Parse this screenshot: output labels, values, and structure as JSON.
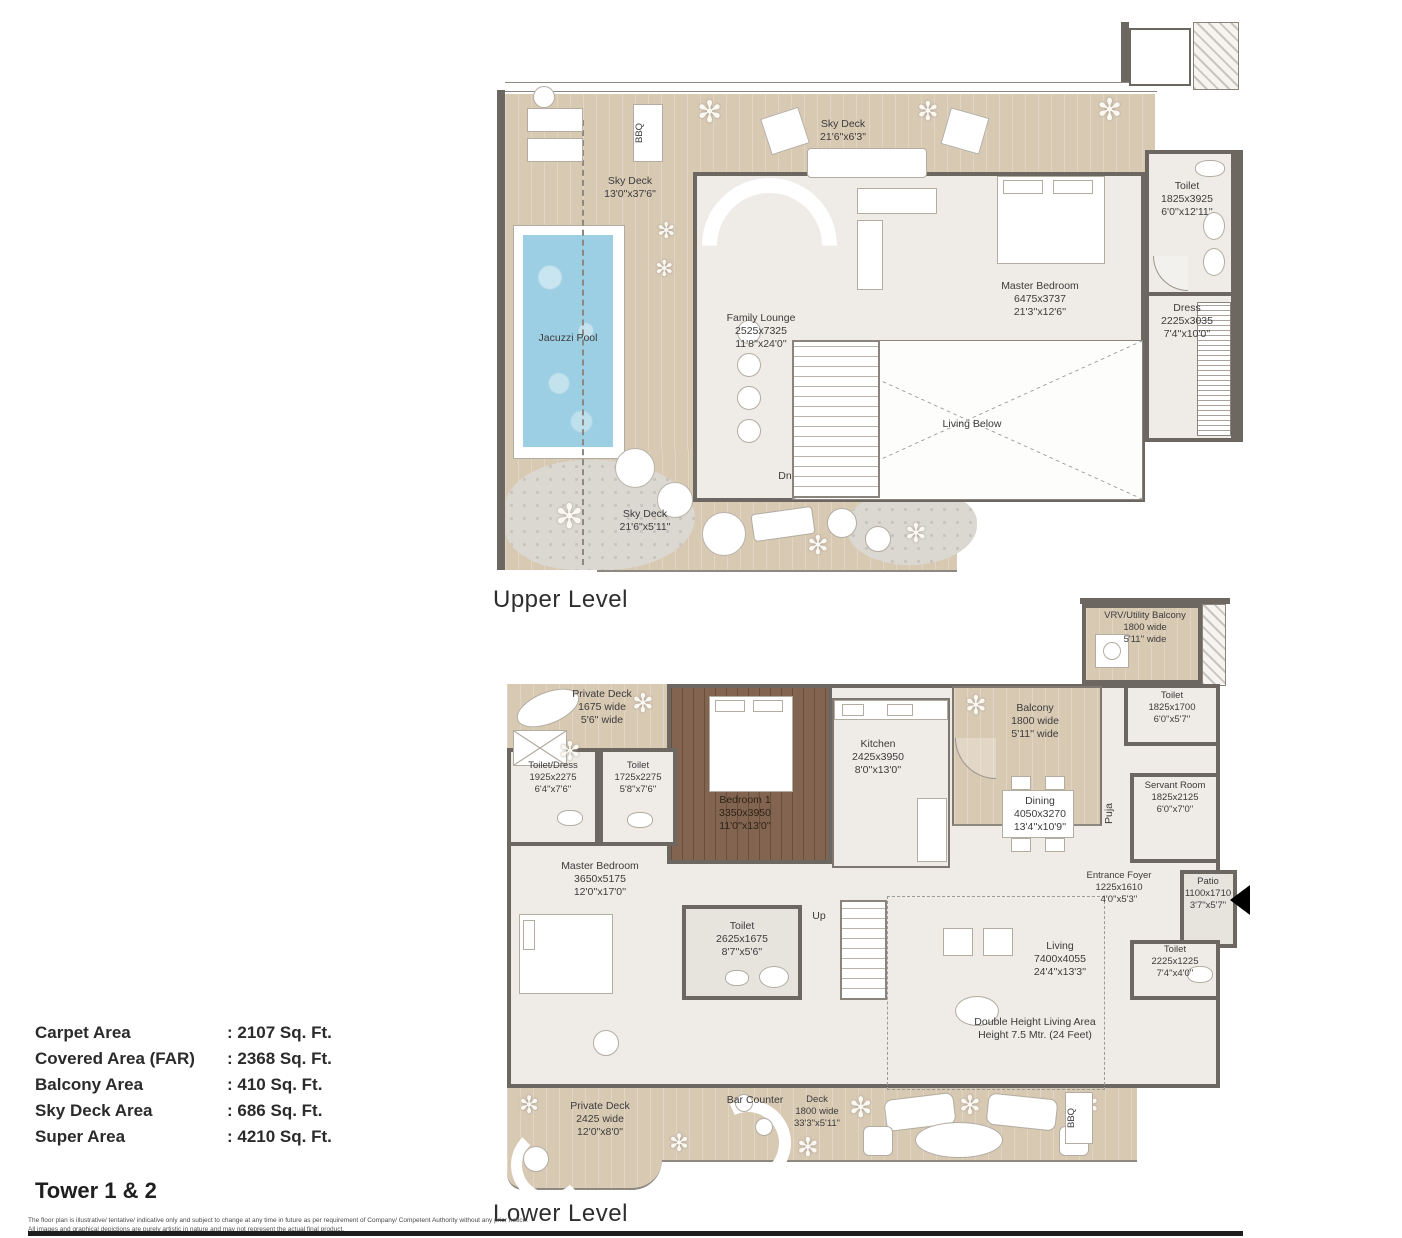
{
  "upper": {
    "caption": "Upper Level",
    "bbq": "BBQ",
    "sky_deck_top": {
      "name": "Sky Deck",
      "ft": "21'6\"x6'3\""
    },
    "sky_deck_left": {
      "name": "Sky Deck",
      "ft": "13'0\"x37'6\""
    },
    "jacuzzi_pool": "Jacuzzi Pool",
    "family_lounge": {
      "name": "Family Lounge",
      "mm": "2525x7325",
      "ft": "11'8''x24'0''"
    },
    "master_bedroom": {
      "name": "Master Bedroom",
      "mm": "6475x3737",
      "ft": "21'3''x12'6''"
    },
    "toilet": {
      "name": "Toilet",
      "mm": "1825x3925",
      "ft": "6'0''x12'11''"
    },
    "dress": {
      "name": "Dress",
      "mm": "2225x3035",
      "ft": "7'4''x10'0''"
    },
    "living_below": "Living Below",
    "dn": "Dn",
    "sky_deck_bottom": {
      "name": "Sky Deck",
      "ft": "21'6\"x5'11\""
    }
  },
  "lower": {
    "caption": "Lower Level",
    "vrv_balcony": {
      "name": "VRV/Utility Balcony",
      "mm": "1800 wide",
      "ft": "5'11'' wide"
    },
    "toilet_vrv": {
      "name": "Toilet",
      "mm": "1825x1700",
      "ft": "6'0''x5'7''"
    },
    "private_deck_top": {
      "name": "Private Deck",
      "mm": "1675 wide",
      "ft": "5'6'' wide"
    },
    "toilet_dress": {
      "name": "Toilet/Dress",
      "mm": "1925x2275",
      "ft": "6'4''x7'6''"
    },
    "toilet_2": {
      "name": "Toilet",
      "mm": "1725x2275",
      "ft": "5'8''x7'6''"
    },
    "bedroom_1": {
      "name": "Bedroom 1",
      "mm": "3350x3950",
      "ft": "11'0''x13'0''"
    },
    "kitchen": {
      "name": "Kitchen",
      "mm": "2425x3950",
      "ft": "8'0''x13'0''"
    },
    "balcony": {
      "name": "Balcony",
      "mm": "1800 wide",
      "ft": "5'11'' wide"
    },
    "dining": {
      "name": "Dining",
      "mm": "4050x3270",
      "ft": "13'4''x10'9''"
    },
    "puja": "Puja",
    "servant_room": {
      "name": "Servant Room",
      "mm": "1825x2125",
      "ft": "6'0''x7'0''"
    },
    "entrance_foyer": {
      "name": "Entrance Foyer",
      "mm": "1225x1610",
      "ft": "4'0''x5'3''"
    },
    "patio": {
      "name": "Patio",
      "mm": "1100x1710",
      "ft": "3'7\"x5'7\""
    },
    "toilet_patio": {
      "name": "Toilet",
      "mm": "2225x1225",
      "ft": "7'4''x4'0''"
    },
    "master_bedroom": {
      "name": "Master Bedroom",
      "mm": "3650x5175",
      "ft": "12'0''x17'0''"
    },
    "toilet_3": {
      "name": "Toilet",
      "mm": "2625x1675",
      "ft": "8'7''x5'6''"
    },
    "up": "Up",
    "living": {
      "name": "Living",
      "mm": "7400x4055",
      "ft": "24'4''x13'3''"
    },
    "double_height": {
      "line1": "Double Height Living Area",
      "line2": "Height 7.5 Mtr. (24 Feet)"
    },
    "private_deck_bottom": {
      "name": "Private Deck",
      "mm": "2425 wide",
      "ft": "12'0\"x8'0\""
    },
    "bar_counter": "Bar Counter",
    "deck": {
      "name": "Deck",
      "mm": "1800 wide",
      "ft": "33'3\"x5'11\""
    },
    "bbq": "BBQ"
  },
  "stats": {
    "rows": [
      {
        "label": "Carpet Area",
        "value": "2107 Sq. Ft."
      },
      {
        "label": "Covered Area (FAR)",
        "value": "2368 Sq. Ft."
      },
      {
        "label": "Balcony Area",
        "value": "410 Sq. Ft."
      },
      {
        "label": "Sky Deck Area",
        "value": "686 Sq. Ft."
      },
      {
        "label": "Super Area",
        "value": "4210 Sq. Ft."
      }
    ]
  },
  "footer": {
    "title": "Tower 1 & 2",
    "disclaimer_1": "The floor plan is illustrative/ tentative/ indicative only and subject to change at any time in future as per requirement of Company/ Competent Authority without any prior notice.",
    "disclaimer_2": "All images and graphical depictions are purely artistic in nature and may not represent the actual final product."
  },
  "colors": {
    "deck_wood": "#d8c9b3",
    "dark_wood": "#7a5b46",
    "marble": "#efece7",
    "pool_blue": "#9ccfe3",
    "wall": "#6d6761"
  }
}
